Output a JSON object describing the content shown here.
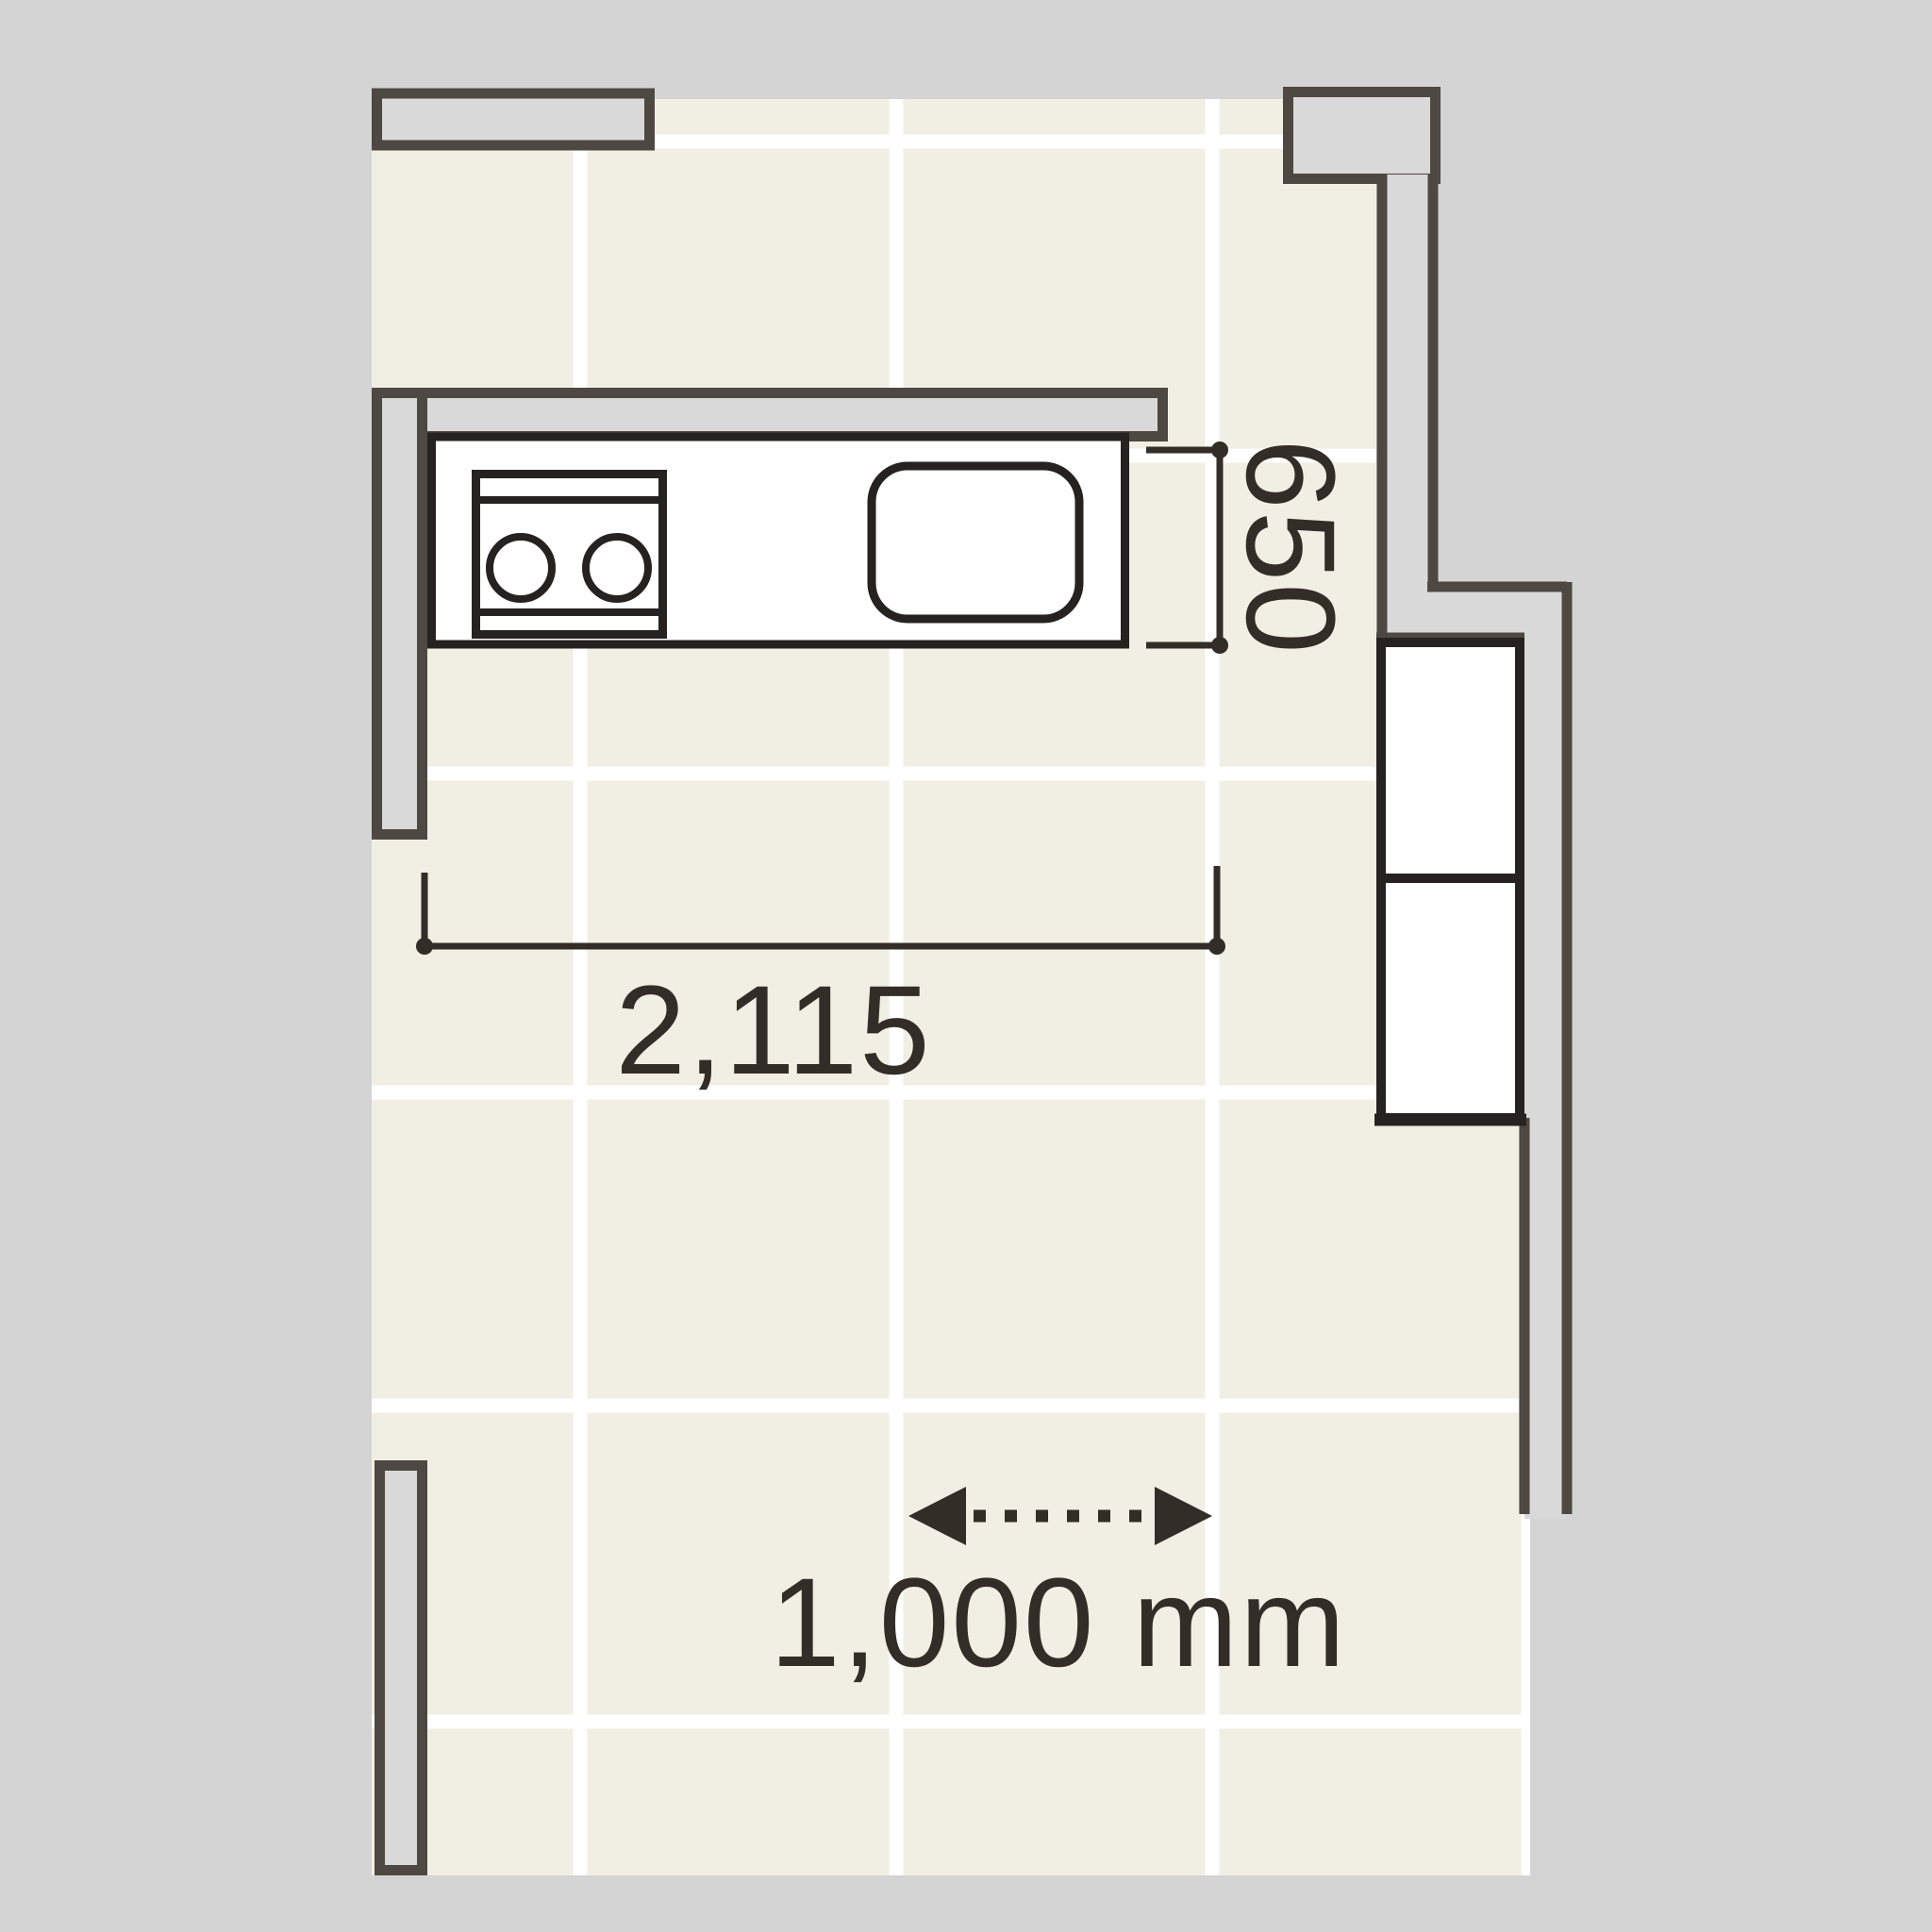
{
  "dimensions": {
    "counter_length_label": "2,115",
    "counter_depth_label": "650",
    "tile_scale_label": "1,000 mm"
  },
  "colors": {
    "bg_outside": "#d4d4d4",
    "floor": "#f1eee3",
    "grid_line": "#ffffff",
    "wall_fill": "#d9d9d9",
    "wall_outline": "#4e4842",
    "fixture_outline": "#262220",
    "dim_ink": "#332d27"
  }
}
